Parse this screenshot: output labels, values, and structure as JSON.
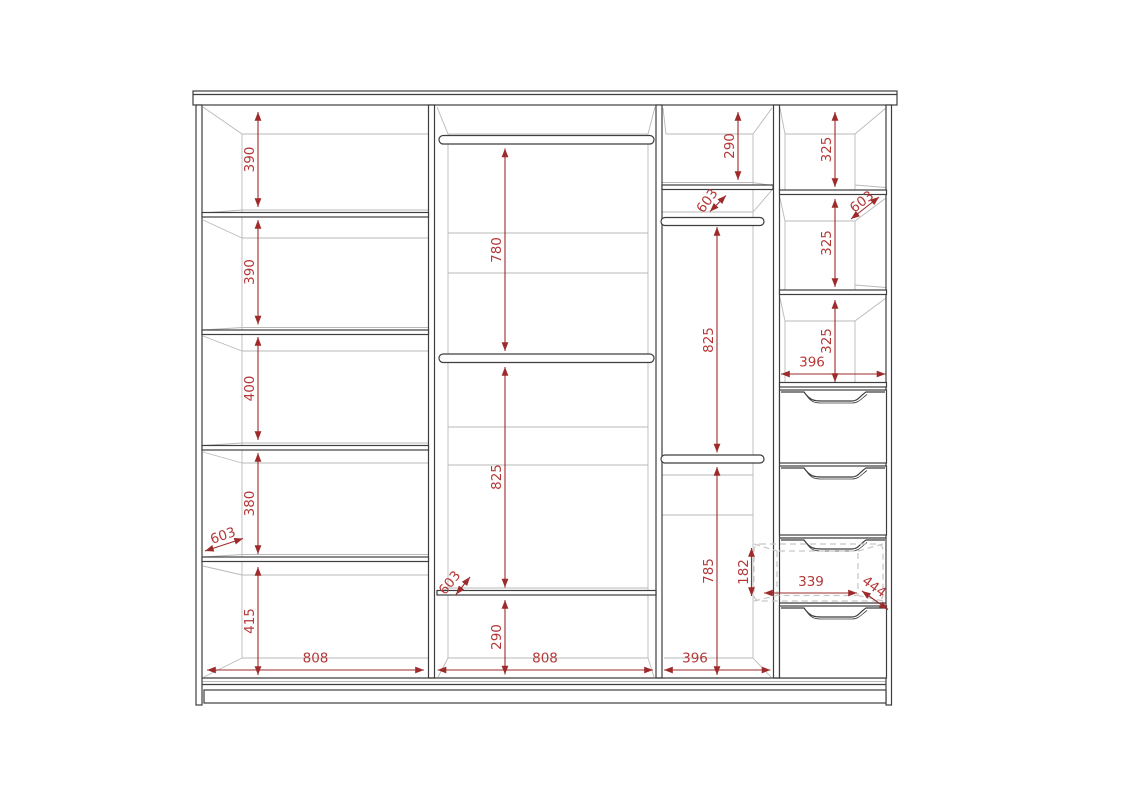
{
  "diagram": {
    "kind": "wardrobe-interior-elevation",
    "units": "mm",
    "colors": {
      "dimension_line": "#9e2b2b",
      "dimension_text": "#b43838",
      "outline": "#3e3e3e",
      "perspective_line": "#b9b9b9",
      "dashed_outline": "#c6c6c6",
      "background": "#ffffff"
    }
  },
  "dims": {
    "left": {
      "g0": "390",
      "g1": "390",
      "g2": "400",
      "g3": "380",
      "g4": "415",
      "width": "808",
      "depth": "603"
    },
    "middle": {
      "rod1": "780",
      "rod2": "825",
      "bottom": "290",
      "width": "808",
      "depth": "603"
    },
    "third": {
      "top": "290",
      "rod1": "825",
      "rod2": "785",
      "width": "396",
      "depth": "603"
    },
    "right": {
      "g0": "325",
      "g1": "325",
      "g2": "325",
      "width": "396",
      "depth": "603",
      "drawer_h": "182",
      "drawer_w": "339",
      "drawer_d": "444"
    }
  }
}
